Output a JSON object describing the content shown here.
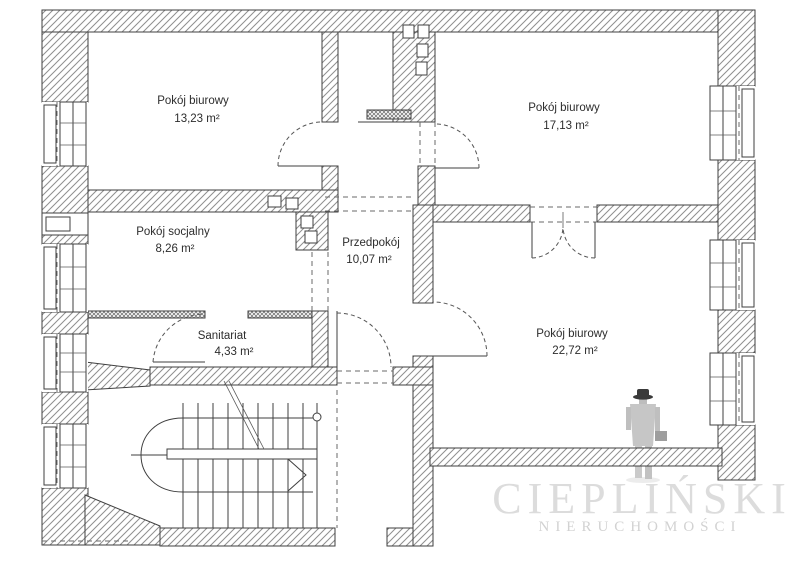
{
  "plan": {
    "rooms": [
      {
        "id": "pokoj-biurowy-1",
        "name": "Pokój biurowy",
        "area": "13,23 m²"
      },
      {
        "id": "pokoj-biurowy-2",
        "name": "Pokój biurowy",
        "area": "17,13 m²"
      },
      {
        "id": "pokoj-socjalny",
        "name": "Pokój socjalny",
        "area": "8,26 m²"
      },
      {
        "id": "przedpokoj",
        "name": "Przedpokój",
        "area": "10,07 m²"
      },
      {
        "id": "sanitariat",
        "name": "Sanitariat",
        "area": "4,33 m²"
      },
      {
        "id": "pokoj-biurowy-3",
        "name": "Pokój biurowy",
        "area": "22,72 m²"
      }
    ],
    "colors": {
      "line": "#3f3f3f",
      "hatch": "#8f8f8f",
      "background": "#ffffff",
      "watermark_text": "#dcdcdc",
      "watermark_figure": "#c6c6c6",
      "watermark_hat": "#3a3a3a"
    }
  },
  "watermark": {
    "brand": "CIEPLIŃSKI",
    "subtitle": "NIERUCHOMOŚCI"
  }
}
